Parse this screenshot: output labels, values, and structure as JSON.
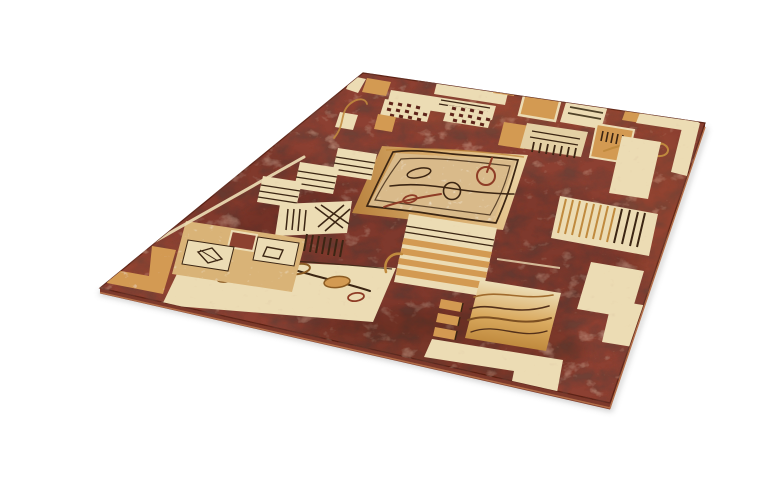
{
  "image": {
    "type": "product-photo",
    "subject": "geometric-area-rug",
    "description": "Rectangular area rug photographed at an angle on a white background; russet-brown mottled field with beige, cream and gold geometric blocks, a central speckled tan square medallion with vine and leaf motifs, striped bars, hatch squares and L-shaped corner blocks.",
    "background": "#ffffff"
  },
  "palette": {
    "background": "#ffffff",
    "field": "#8c4130",
    "field_dark": "#5e241a",
    "cream": "#ecdcb4",
    "beige": "#e4d0a4",
    "gold": "#d39a52",
    "gold_line": "#c08a3e",
    "sand": "#d9b377",
    "tan_med": "#d9ba8a",
    "dark_line": "#3b2513",
    "red_line": "#8e3c26",
    "side": "#7c392b",
    "side_edge": "#b5714a",
    "shadow": "#8f8f8f"
  }
}
